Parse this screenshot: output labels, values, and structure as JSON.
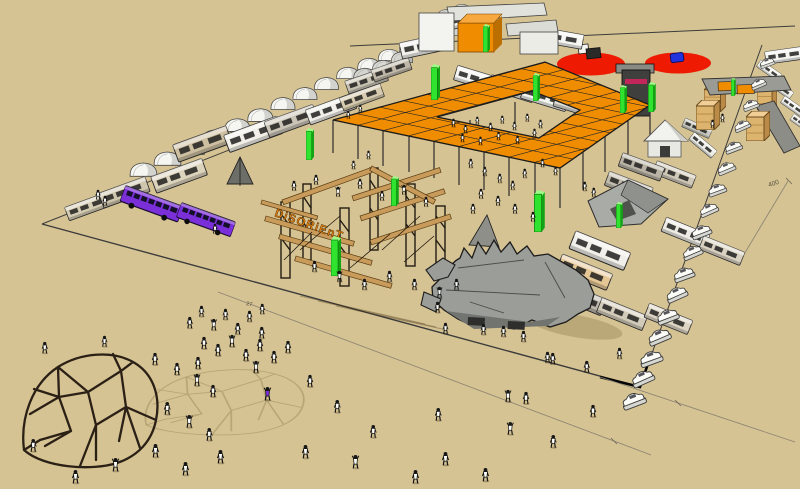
{
  "labels": {
    "sign": "DiSORiEnT",
    "dim27": "27",
    "dim400": "400"
  },
  "colors": {
    "ground": "#D6C393",
    "canopy": "#F08C00",
    "pillar": "#2FE32F",
    "pillar_dark": "#12A412",
    "pillar_light": "#9CFD86",
    "red": "#EE1B02",
    "purple": "#7B2FD8",
    "wood": "#C89B5A",
    "dark": "#221C13",
    "scorpion": "#9B9D99",
    "dome": "#2A2015",
    "shadow": "#B3A172",
    "line": "#3C3C3C",
    "sign": "#E8830D"
  },
  "scene": {
    "tents": [
      [
        128,
        158,
        31
      ],
      [
        152,
        147,
        31
      ],
      [
        176,
        136,
        30
      ],
      [
        200,
        125,
        30
      ],
      [
        223,
        114,
        29
      ],
      [
        246,
        104,
        29
      ],
      [
        269,
        93,
        28
      ],
      [
        291,
        83,
        28
      ],
      [
        313,
        73,
        27
      ],
      [
        335,
        63,
        26
      ],
      [
        356,
        54,
        26
      ],
      [
        377,
        45,
        25
      ],
      [
        398,
        37,
        24
      ],
      [
        419,
        29,
        23
      ],
      [
        440,
        22,
        22
      ],
      [
        352,
        64,
        26,
        "#D6D6D1"
      ],
      [
        371,
        56,
        25,
        "#DADAD5"
      ],
      [
        390,
        48,
        24,
        "#D6D6D1"
      ],
      [
        420,
        12,
        22,
        "#D1D1CC"
      ],
      [
        436,
        6,
        21,
        "#D6D6D1"
      ],
      [
        452,
        1,
        20,
        "#DADAD5"
      ]
    ],
    "rvs_back": [
      [
        62,
        206,
        48,
        18,
        "#D5CCB4",
        -20
      ],
      [
        95,
        192,
        55,
        20,
        "#CFC6AE",
        -20
      ],
      [
        148,
        175,
        58,
        22,
        "#DCD3BC",
        -20
      ],
      [
        170,
        143,
        60,
        23,
        "#CDBFA0",
        -20
      ],
      [
        222,
        133,
        58,
        23,
        "#F1EFE8",
        -20
      ],
      [
        262,
        120,
        54,
        21,
        "#C9C4B6",
        -20
      ],
      [
        304,
        108,
        50,
        20,
        "#EFEEE8",
        -20
      ],
      [
        338,
        96,
        44,
        18,
        "#D6CBAE",
        -20
      ],
      [
        342,
        80,
        46,
        17,
        "#C8C2B2",
        -19
      ],
      [
        368,
        69,
        44,
        16,
        "#BFB8A9",
        -19
      ],
      [
        398,
        40,
        52,
        22,
        "#F2F1EC",
        -12
      ],
      [
        455,
        62,
        54,
        19,
        "#F4F4F0",
        17
      ],
      [
        488,
        71,
        56,
        19,
        "#E6E6E0",
        17
      ],
      [
        521,
        80,
        56,
        19,
        "#F4F4F0",
        17
      ],
      [
        554,
        89,
        52,
        18,
        "#DDDDD6",
        17
      ],
      [
        562,
        74,
        46,
        17,
        "#D9CBA8",
        16
      ],
      [
        762,
        58,
        26,
        12,
        "#F2F2EE",
        35
      ],
      [
        774,
        76,
        26,
        12,
        "#EFEFEA",
        35
      ],
      [
        786,
        94,
        26,
        12,
        "#F2F2EE",
        35
      ],
      [
        795,
        112,
        24,
        11,
        "#EFEFEA",
        35
      ],
      [
        763,
        50,
        42,
        16,
        "#F4F4F1",
        -8
      ],
      [
        540,
        22,
        46,
        24,
        "#F6F6F3",
        10
      ],
      [
        420,
        20,
        46,
        20,
        "#F3F3EF",
        -15
      ]
    ],
    "rvs_front": [
      [
        608,
        168,
        52,
        19,
        "#C2BCAE",
        21
      ],
      [
        656,
        158,
        46,
        17,
        "#CFC8B8",
        21
      ],
      [
        622,
        150,
        48,
        18,
        "#B9B3A5",
        20
      ],
      [
        572,
        226,
        70,
        24,
        "#F1EFE9",
        22
      ],
      [
        560,
        250,
        62,
        22,
        "#E5C795",
        22
      ],
      [
        556,
        276,
        58,
        22,
        "#BCB6AA",
        22
      ],
      [
        600,
        294,
        56,
        20,
        "#D2CBBA",
        22
      ],
      [
        648,
        300,
        52,
        19,
        "#DCD5C4",
        22
      ],
      [
        665,
        214,
        52,
        19,
        "#ECEAE2",
        22
      ],
      [
        703,
        233,
        48,
        18,
        "#D9D2C2",
        22
      ],
      [
        686,
        116,
        30,
        13,
        "#C9C9C2",
        24
      ],
      [
        696,
        130,
        30,
        14,
        "#EDEDE8",
        40
      ]
    ],
    "buses": [
      [
        127,
        181,
        62,
        25,
        20
      ],
      [
        183,
        198,
        58,
        24,
        20
      ]
    ],
    "cars": [
      [
        757,
        60,
        0.75,
        -20
      ],
      [
        748,
        81,
        0.78,
        -23
      ],
      [
        740,
        102,
        0.81,
        -20
      ],
      [
        731,
        123,
        0.84,
        -24
      ],
      [
        722,
        144,
        0.87,
        -21
      ],
      [
        714,
        165,
        0.9,
        -23
      ],
      [
        705,
        186,
        0.93,
        -20
      ],
      [
        696,
        207,
        0.96,
        -24
      ],
      [
        688,
        228,
        0.99,
        -21
      ],
      [
        679,
        249,
        1.02,
        -23
      ],
      [
        670,
        270,
        1.05,
        -20
      ],
      [
        662,
        291,
        1.08,
        -24
      ],
      [
        653,
        312,
        1.1,
        -21
      ],
      [
        644,
        333,
        1.12,
        -23
      ],
      [
        636,
        354,
        1.14,
        -20
      ],
      [
        627,
        375,
        1.16,
        -24
      ],
      [
        618,
        396,
        1.18,
        -21
      ]
    ],
    "pillars": [
      [
        306,
        128,
        32
      ],
      [
        431,
        64,
        36
      ],
      [
        483,
        24,
        28
      ],
      [
        533,
        73,
        28
      ],
      [
        620,
        85,
        28
      ],
      [
        648,
        82,
        30
      ],
      [
        730,
        78,
        18
      ],
      [
        534,
        190,
        42
      ],
      [
        616,
        202,
        26
      ],
      [
        391,
        176,
        30
      ],
      [
        331,
        236,
        40
      ]
    ],
    "posts": [
      [
        333,
        120,
        33
      ],
      [
        358,
        125,
        34
      ],
      [
        383,
        131,
        35
      ],
      [
        409,
        136,
        36
      ],
      [
        434,
        141,
        37
      ],
      [
        459,
        147,
        38
      ],
      [
        484,
        152,
        38
      ],
      [
        509,
        157,
        39
      ],
      [
        535,
        163,
        40
      ],
      [
        560,
        168,
        40
      ],
      [
        583,
        152,
        38
      ],
      [
        605,
        136,
        36
      ],
      [
        628,
        121,
        33
      ],
      [
        650,
        105,
        31
      ],
      [
        470,
        120,
        26
      ],
      [
        515,
        102,
        24
      ]
    ],
    "crates_back": [
      [
        704,
        84,
        22
      ],
      [
        757,
        85,
        20
      ]
    ],
    "crates_front": [
      [
        696,
        100,
        24
      ],
      [
        746,
        111,
        24
      ]
    ],
    "people": [
      [
        450,
        118,
        0.7,
        1
      ],
      [
        462,
        124,
        0.7,
        1
      ],
      [
        474,
        116,
        0.65,
        1
      ],
      [
        487,
        122,
        0.7,
        1
      ],
      [
        499,
        115,
        0.65,
        1
      ],
      [
        511,
        121,
        0.7,
        1
      ],
      [
        524,
        113,
        0.65,
        1
      ],
      [
        537,
        119,
        0.7,
        1
      ],
      [
        459,
        133,
        0.7,
        1
      ],
      [
        477,
        136,
        0.7,
        1
      ],
      [
        495,
        131,
        0.7,
        1
      ],
      [
        514,
        135,
        0.7,
        1
      ],
      [
        531,
        128,
        0.7,
        1
      ],
      [
        467,
        158,
        0.75,
        1
      ],
      [
        481,
        166,
        0.75,
        1
      ],
      [
        496,
        173,
        0.75,
        1
      ],
      [
        509,
        180,
        0.75,
        1
      ],
      [
        521,
        168,
        0.75,
        1
      ],
      [
        539,
        158,
        0.7,
        1
      ],
      [
        552,
        166,
        0.7,
        1
      ],
      [
        477,
        188,
        0.8,
        1
      ],
      [
        494,
        195,
        0.8,
        1
      ],
      [
        511,
        203,
        0.8,
        1
      ],
      [
        529,
        211,
        0.8,
        1
      ],
      [
        469,
        203,
        0.8,
        1
      ],
      [
        365,
        150,
        0.7,
        1
      ],
      [
        350,
        160,
        0.7,
        1
      ],
      [
        290,
        180,
        0.8,
        1
      ],
      [
        312,
        174,
        0.8,
        1
      ],
      [
        334,
        186,
        0.8,
        2
      ],
      [
        356,
        178,
        0.8,
        1
      ],
      [
        378,
        190,
        0.8,
        1
      ],
      [
        400,
        184,
        0.8,
        2
      ],
      [
        422,
        196,
        0.8,
        1
      ],
      [
        310,
        260,
        0.9,
        1
      ],
      [
        335,
        270,
        0.9,
        2
      ],
      [
        360,
        278,
        0.9,
        1
      ],
      [
        385,
        270,
        0.9,
        1
      ],
      [
        410,
        278,
        0.9,
        1
      ],
      [
        435,
        286,
        0.9,
        2
      ],
      [
        452,
        278,
        0.9,
        1
      ],
      [
        433,
        301,
        0.9,
        1
      ],
      [
        441,
        322,
        0.9,
        1
      ],
      [
        479,
        323,
        0.9,
        1
      ],
      [
        499,
        325,
        0.9,
        1
      ],
      [
        519,
        330,
        0.9,
        1
      ],
      [
        543,
        351,
        0.9,
        1
      ],
      [
        185,
        316,
        0.95,
        1
      ],
      [
        197,
        305,
        0.9,
        1
      ],
      [
        209,
        318,
        0.95,
        2
      ],
      [
        221,
        308,
        0.9,
        1
      ],
      [
        233,
        322,
        0.95,
        1
      ],
      [
        245,
        310,
        0.9,
        1
      ],
      [
        257,
        326,
        0.95,
        1
      ],
      [
        199,
        336,
        1,
        1
      ],
      [
        213,
        343,
        1,
        1
      ],
      [
        227,
        334,
        1,
        2
      ],
      [
        241,
        348,
        1,
        1
      ],
      [
        255,
        338,
        1,
        1
      ],
      [
        269,
        350,
        1,
        1
      ],
      [
        283,
        340,
        1,
        1
      ],
      [
        193,
        356,
        1,
        1
      ],
      [
        251,
        360,
        1,
        2
      ],
      [
        258,
        303,
        0.85,
        1
      ],
      [
        150,
        352,
        1,
        1
      ],
      [
        172,
        362,
        1,
        1
      ],
      [
        192,
        373,
        1,
        2
      ],
      [
        208,
        384,
        1,
        1
      ],
      [
        40,
        341,
        0.95,
        1
      ],
      [
        100,
        335,
        0.9,
        1
      ],
      [
        162,
        401,
        1.05,
        1
      ],
      [
        184,
        414,
        1.05,
        2
      ],
      [
        204,
        427,
        1.05,
        1
      ],
      [
        150,
        443,
        1.1,
        1
      ],
      [
        110,
        457,
        1.1,
        2
      ],
      [
        70,
        469,
        1.1,
        1
      ],
      [
        180,
        461,
        1.1,
        1
      ],
      [
        215,
        449,
        1.1,
        1
      ],
      [
        28,
        438,
        1.05,
        1
      ],
      [
        262,
        386,
        1.1,
        2,
        "#7B2FD8"
      ],
      [
        305,
        374,
        1,
        1
      ],
      [
        332,
        399,
        1.05,
        1
      ],
      [
        368,
        424,
        1.05,
        1
      ],
      [
        433,
        407,
        1.05,
        1
      ],
      [
        503,
        389,
        1,
        2
      ],
      [
        521,
        391,
        1,
        1
      ],
      [
        505,
        421,
        1.05,
        2
      ],
      [
        440,
        451,
        1.1,
        1
      ],
      [
        480,
        467,
        1.1,
        1
      ],
      [
        548,
        434,
        1.05,
        1
      ],
      [
        588,
        404,
        1,
        1
      ],
      [
        350,
        454,
        1.1,
        2
      ],
      [
        300,
        444,
        1.1,
        1
      ],
      [
        410,
        469,
        1.1,
        1
      ],
      [
        548,
        352,
        0.95,
        1
      ],
      [
        582,
        360,
        0.95,
        1
      ],
      [
        615,
        347,
        0.9,
        1
      ],
      [
        94,
        189,
        0.8,
        1
      ],
      [
        101,
        195,
        0.8,
        1
      ],
      [
        211,
        223,
        0.8,
        1
      ],
      [
        581,
        181,
        0.75,
        1
      ],
      [
        590,
        187,
        0.75,
        1
      ],
      [
        709,
        119,
        0.7,
        1
      ],
      [
        719,
        113,
        0.7,
        1
      ],
      [
        345,
        110,
        0.65,
        1
      ],
      [
        357,
        104,
        0.65,
        1
      ]
    ]
  }
}
